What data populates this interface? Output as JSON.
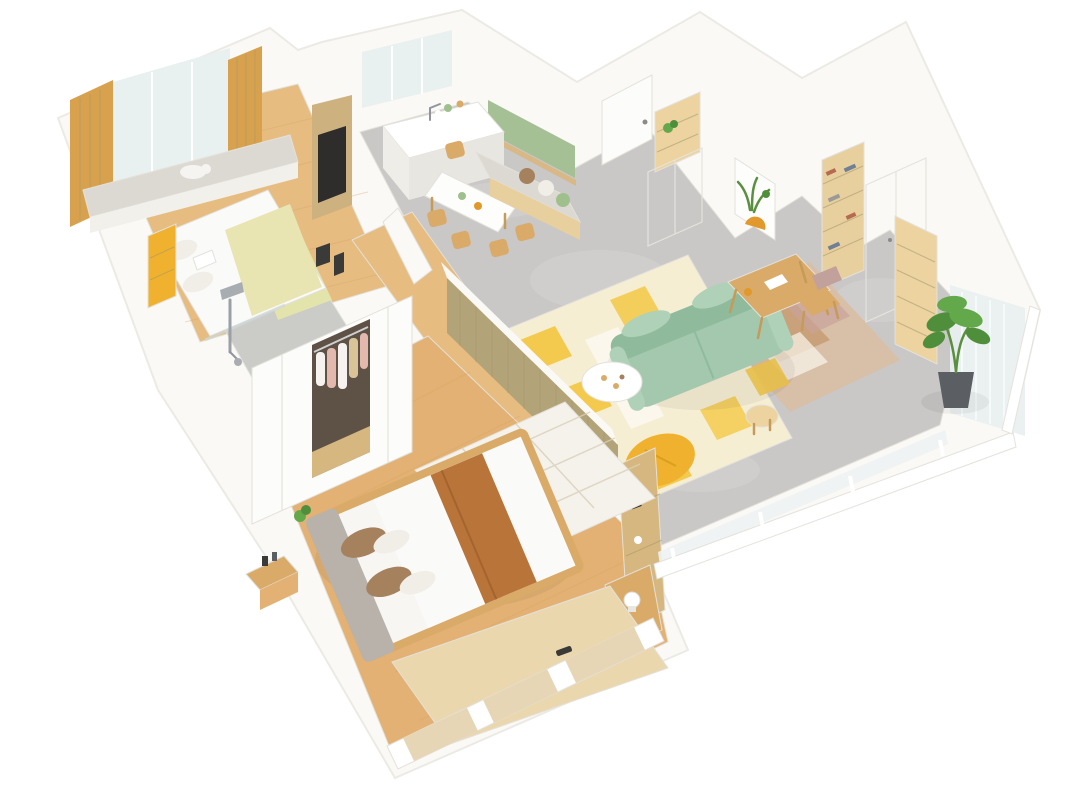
{
  "meta": {
    "title": "3D isometric apartment floor-plan render",
    "view": "axonometric cutaway, white background",
    "rooms": [
      {
        "name": "small-bedroom",
        "items": [
          "bay window",
          "sheer curtain",
          "gold drapes",
          "window bench",
          "polar bear plush",
          "double bed",
          "pale-yellow duvet",
          "yellow bookshelf",
          "wood media panel with TV",
          "pale green rug"
        ]
      },
      {
        "name": "kitchen-dining",
        "items": [
          "window",
          "white island with black faucet",
          "black countertop appliances",
          "white dining table",
          "wood chairs",
          "bench seat",
          "green accent panel with wood shelf",
          "throw pillows"
        ]
      },
      {
        "name": "entry-hall",
        "items": [
          "white entry door",
          "built-in cabinet with wood niche",
          "potted plant"
        ]
      },
      {
        "name": "living-room",
        "items": [
          "mint 3-seat sofa",
          "yellow-white geometric rug",
          "white round coffee table",
          "yellow lounge pouf",
          "round wood side table",
          "wood writing desk",
          "chair with mauve cushion",
          "abstract earth-tone rug",
          "framed botanical artwork",
          "glass-front bookshelf",
          "white wardrobe cabinets"
        ]
      },
      {
        "name": "balcony",
        "items": [
          "white glass railing",
          "sheer curtain",
          "wood shoe shelf",
          "potted tree in dark pot"
        ]
      },
      {
        "name": "bathroom",
        "items": [
          "chrome rain shower",
          "glass screen",
          "gray tile floor"
        ]
      },
      {
        "name": "master-bedroom",
        "items": [
          "wardrobe with open hanging section",
          "platform wood bed",
          "white duvet with caramel throw",
          "brown and white pillows",
          "patterned white rug",
          "wood nightstand",
          "wood-slat partition wall",
          "pegboard shelf panel",
          "table lamp on wood ledge",
          "cream floor mat",
          "low bay windows"
        ]
      }
    ]
  },
  "palette": {
    "wall": "#faf9f6",
    "wallShade": "#f2f0ea",
    "white": "#ffffff",
    "wood": "#e6bc81",
    "wood2": "#e2b173",
    "concrete": "#c9c8c6",
    "concreteLight": "#d5d4d2",
    "tile": "#cbcbc8",
    "sheer": "#e9f0f0",
    "curtain": "#d8a14e",
    "curtainDark": "#c8913e",
    "bench": "#dcd9d3",
    "bear": "#f6f4f0",
    "bedWhite": "#fafaf8",
    "duvetYellow": "#e8e5b2",
    "rugGreen": "#e3e3ac",
    "woodPanel": "#cdb27f",
    "tv": "#2e2d2b",
    "black": "#3a3a38",
    "islandSide": "#efede7",
    "islandSide2": "#e8e6e0",
    "green": "#a6c096",
    "tableWhite": "#fdfdfc",
    "chairWood": "#d9aa68",
    "pillowBrown": "#a5815e",
    "pillowWhite": "#f1eee8",
    "pillowGreen": "#9fc08c",
    "door": "#fcfcfa",
    "handle": "#8b8b8b",
    "niche": "#ecd3a0",
    "shelfWood": "#e8cf9e",
    "shelfLine": "#d8b887",
    "artBg": "#fdfdfc",
    "artGreen": "#5a8f3f",
    "artOrange": "#e1992c",
    "bookA": "#b56a52",
    "bookB": "#6f7f95",
    "bookC": "#9a9a96",
    "sofa": "#a3c8ae",
    "sofaDark": "#8fbb9c",
    "sofaLight": "#aed1b8",
    "rugCream": "#f6eed3",
    "rugYellow": "#f4ca4e",
    "rugWhite": "#fbf7ec",
    "pouf": "#f0b22e",
    "deskRug": "#d8bfa8",
    "deskRugTan": "#c59a6e",
    "deskRugRose": "#c9a29b",
    "cushionPink": "#c2a09b",
    "slat": "#b2a478",
    "pegboard": "#d6b77f",
    "wardrobeIn": "#5e5145",
    "clothesPink": "#e3b8ad",
    "clothesWhite": "#f5f2ef",
    "clothesBeige": "#d9c49a",
    "caramel": "#b9743a",
    "headboard": "#b9b2aa",
    "mattress": "#f7f6f3",
    "rug2": "#f4f2ea",
    "mat": "#ead7ae",
    "chrome": "#a8adb2",
    "plant": "#4f8f3c",
    "plantLight": "#63a84a",
    "pot": "#5b5f63",
    "glass": "#eef2f3",
    "paneWood": "#e7d6b6"
  }
}
